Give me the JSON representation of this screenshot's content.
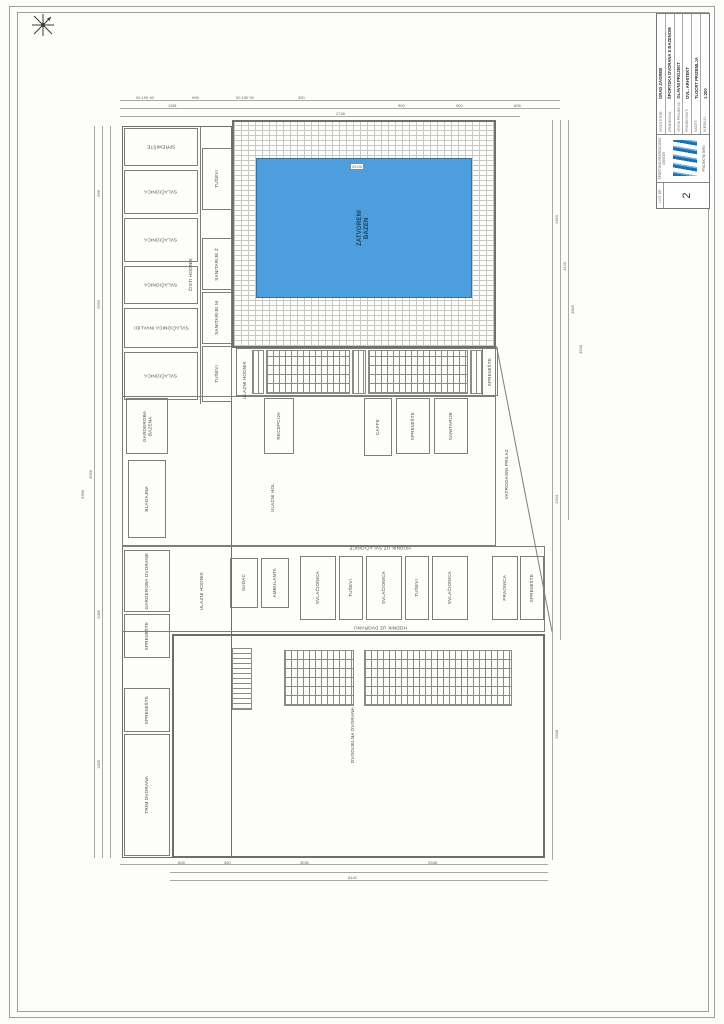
{
  "sheet": {
    "frame_color": "#9f9f9d",
    "paper_color": "#fdfdfc"
  },
  "title_block": {
    "sheet_no_label": "LIST BR.",
    "sheet_no": "2",
    "logo_top": "ŠPORTSKO-REKREACIJSKI CENTAR",
    "logo_bottom": "PROJEKTNI BIRO",
    "rows": [
      {
        "label": "INVESTITOR:",
        "value": "GRAD ZAGREB"
      },
      {
        "label": "GRAĐEVINA:",
        "value": "ŠPORTSKA DVORANA S BAZENOM"
      },
      {
        "label": "VRSTA PROJEKTA:",
        "value": "GLAVNI PROJEKT"
      },
      {
        "label": "PROJEKTANT:",
        "value": "OVL. ARHITEKT"
      },
      {
        "label": "NACRT:",
        "value": "TLOCRT PRIZEMLJA"
      },
      {
        "label": "MJERILO:",
        "value": "1:200"
      }
    ]
  },
  "plan": {
    "pool": {
      "label": "ZATVORENI\nBAZEN",
      "water_color": "#4d9edd",
      "marker": "25,00"
    },
    "hall_label": "DVODIJELNA DVORANA",
    "rooms": [
      {
        "label": "SPREMIŠTE",
        "x": 124,
        "y": 128,
        "w": 74,
        "h": 38,
        "rot": "h180"
      },
      {
        "label": "SVLAČIONICA",
        "x": 124,
        "y": 170,
        "w": 74,
        "h": 44,
        "rot": "h180"
      },
      {
        "label": "SVLAČIONICA",
        "x": 124,
        "y": 218,
        "w": 74,
        "h": 44,
        "rot": "h180"
      },
      {
        "label": "SVLAČIONICA",
        "x": 124,
        "y": 266,
        "w": 74,
        "h": 38,
        "rot": "h180"
      },
      {
        "label": "SVLAČIONICA INVALIDI",
        "x": 124,
        "y": 308,
        "w": 74,
        "h": 40,
        "rot": "h180"
      },
      {
        "label": "SVLAČIONICA",
        "x": 124,
        "y": 352,
        "w": 74,
        "h": 48,
        "rot": "h180"
      },
      {
        "label": "TUŠEVI",
        "x": 202,
        "y": 148,
        "w": 30,
        "h": 62,
        "rot": "v"
      },
      {
        "label": "SANITARIJE Ž",
        "x": 202,
        "y": 238,
        "w": 30,
        "h": 52,
        "rot": "v"
      },
      {
        "label": "SANITARIJE M",
        "x": 202,
        "y": 292,
        "w": 30,
        "h": 52,
        "rot": "v"
      },
      {
        "label": "TUŠEVI",
        "x": 202,
        "y": 346,
        "w": 30,
        "h": 56,
        "rot": "v"
      },
      {
        "label": "ČISTI HODNIK",
        "x": 184,
        "y": 230,
        "w": 14,
        "h": 90,
        "rot": "v",
        "nb": true
      },
      {
        "label": "ULAZNI HODNIK",
        "x": 238,
        "y": 350,
        "w": 13,
        "h": 60,
        "rot": "v",
        "nb": true
      },
      {
        "label": "SPREMIŠTE",
        "x": 482,
        "y": 348,
        "w": 16,
        "h": 48,
        "rot": "v"
      },
      {
        "label": "GARDEROBA BAZENA",
        "x": 126,
        "y": 398,
        "w": 42,
        "h": 56,
        "rot": "v"
      },
      {
        "label": "RECEPCIJA",
        "x": 264,
        "y": 398,
        "w": 30,
        "h": 56,
        "rot": "v"
      },
      {
        "label": "CAFFE",
        "x": 364,
        "y": 398,
        "w": 28,
        "h": 58,
        "rot": "v"
      },
      {
        "label": "SPREMIŠTE",
        "x": 396,
        "y": 398,
        "w": 34,
        "h": 56,
        "rot": "v"
      },
      {
        "label": "SANITARIJE",
        "x": 434,
        "y": 398,
        "w": 34,
        "h": 56,
        "rot": "v"
      },
      {
        "label": "BLAGAJNA",
        "x": 128,
        "y": 460,
        "w": 38,
        "h": 78,
        "rot": "v"
      },
      {
        "label": "ULAZNI HOL",
        "x": 256,
        "y": 466,
        "w": 34,
        "h": 64,
        "rot": "v",
        "nb": true
      },
      {
        "label": "GARDEROBA DVORANE",
        "x": 124,
        "y": 550,
        "w": 46,
        "h": 62,
        "rot": "v"
      },
      {
        "label": "SPREMIŠTE",
        "x": 124,
        "y": 614,
        "w": 46,
        "h": 44,
        "rot": "v"
      },
      {
        "label": "ULAZNI HODNIK",
        "x": 194,
        "y": 552,
        "w": 16,
        "h": 78,
        "rot": "v",
        "nb": true
      },
      {
        "label": "SUDAC",
        "x": 230,
        "y": 558,
        "w": 28,
        "h": 50,
        "rot": "v"
      },
      {
        "label": "AMBULANTA",
        "x": 261,
        "y": 558,
        "w": 28,
        "h": 50,
        "rot": "v"
      },
      {
        "label": "SVLAČIONICA",
        "x": 300,
        "y": 556,
        "w": 36,
        "h": 64,
        "rot": "v"
      },
      {
        "label": "TUŠEVI",
        "x": 339,
        "y": 556,
        "w": 24,
        "h": 64,
        "rot": "v"
      },
      {
        "label": "SVLAČIONICA",
        "x": 366,
        "y": 556,
        "w": 36,
        "h": 64,
        "rot": "v"
      },
      {
        "label": "TUŠEVI",
        "x": 405,
        "y": 556,
        "w": 24,
        "h": 64,
        "rot": "v"
      },
      {
        "label": "SVLAČIONICA",
        "x": 432,
        "y": 556,
        "w": 36,
        "h": 64,
        "rot": "v"
      },
      {
        "label": "PRAONICA",
        "x": 492,
        "y": 556,
        "w": 26,
        "h": 64,
        "rot": "v"
      },
      {
        "label": "SPREMIŠTE",
        "x": 520,
        "y": 556,
        "w": 24,
        "h": 64,
        "rot": "v"
      },
      {
        "label": "HODNIK UZ SVLAČIONICE",
        "x": 290,
        "y": 543,
        "w": 180,
        "h": 10,
        "rot": "h180",
        "nb": true
      },
      {
        "label": "HODNIK UZ DVORANU",
        "x": 290,
        "y": 623,
        "w": 180,
        "h": 10,
        "rot": "h180",
        "nb": true
      },
      {
        "label": "DVODIJELNA DVORANA",
        "x": 336,
        "y": 696,
        "w": 34,
        "h": 78,
        "rot": "v",
        "nb": true
      },
      {
        "label": "SPREMIŠTE",
        "x": 124,
        "y": 688,
        "w": 46,
        "h": 44,
        "rot": "v"
      },
      {
        "label": "TRIM DVORANA",
        "x": 124,
        "y": 734,
        "w": 46,
        "h": 122,
        "rot": "v"
      },
      {
        "label": "VATROGASNI PRILAZ",
        "x": 500,
        "y": 428,
        "w": 13,
        "h": 92,
        "rot": "v",
        "nb": true
      }
    ],
    "dims": [
      {
        "t": "90 190 90",
        "x": 136,
        "y": 95
      },
      {
        "t": "995",
        "x": 192,
        "y": 95
      },
      {
        "t": "90 190 90",
        "x": 236,
        "y": 95
      },
      {
        "t": "300",
        "x": 298,
        "y": 95
      },
      {
        "t": "1581",
        "x": 168,
        "y": 103
      },
      {
        "t": "900",
        "x": 398,
        "y": 103
      },
      {
        "t": "900",
        "x": 456,
        "y": 103
      },
      {
        "t": "608",
        "x": 514,
        "y": 103
      },
      {
        "t": "2748",
        "x": 336,
        "y": 111
      },
      {
        "t": "585",
        "x": 96,
        "y": 190,
        "v": 1
      },
      {
        "t": "2550",
        "x": 96,
        "y": 300,
        "v": 1
      },
      {
        "t": "3036",
        "x": 88,
        "y": 470,
        "v": 1
      },
      {
        "t": "2085",
        "x": 96,
        "y": 610,
        "v": 1
      },
      {
        "t": "1485",
        "x": 96,
        "y": 760,
        "v": 1
      },
      {
        "t": "9366",
        "x": 80,
        "y": 490,
        "v": 1
      },
      {
        "t": "2450",
        "x": 554,
        "y": 215,
        "v": 1
      },
      {
        "t": "3145",
        "x": 562,
        "y": 262,
        "v": 1
      },
      {
        "t": "3860",
        "x": 570,
        "y": 305,
        "v": 1
      },
      {
        "t": "3530",
        "x": 578,
        "y": 345,
        "v": 1
      },
      {
        "t": "1294",
        "x": 554,
        "y": 495,
        "v": 1
      },
      {
        "t": "2948",
        "x": 554,
        "y": 730,
        "v": 1
      },
      {
        "t": "608",
        "x": 178,
        "y": 860
      },
      {
        "t": "300",
        "x": 224,
        "y": 860
      },
      {
        "t": "3030",
        "x": 300,
        "y": 860
      },
      {
        "t": "2948",
        "x": 428,
        "y": 860
      },
      {
        "t": "8142",
        "x": 348,
        "y": 875
      }
    ]
  }
}
